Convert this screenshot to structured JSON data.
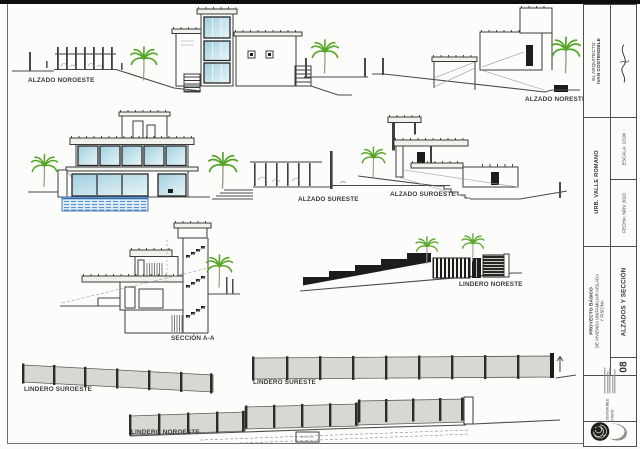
{
  "sheet": {
    "labels": {
      "alzado_noroeste": "ALZADO NOROESTE",
      "alzado_noreste": "ALZADO NORESTE",
      "alzado_sureste": "ALZADO SURESTE",
      "alzado_suroeste": "ALZADO SUROESTE",
      "seccion_aa": "SECCIÓN A-A",
      "lindero_noreste": "LINDERO NORESTE",
      "lindero_suroeste": "LINDERO SUROESTE",
      "lindero_sureste": "LINDERO SURESTE",
      "lindero_noroeste": "LINDERO NOROESTE"
    },
    "titleblock": {
      "architect_label": "EL ARQUITECTO:",
      "architect_name": "IVAN COSTENOBLE",
      "urbanization": "URB. VALLE ROMANO",
      "scale": "ESCALA: 1/100",
      "date": "FECHA: NOV 2010",
      "project_line1": "PROYECTO BÁSICO",
      "project_line2": "DE VIVIENDA UNIFAMILIAR AISLADA",
      "project_line3": "Y PISCINA",
      "sheet_number": "08",
      "sheet_title": "ALZADOS Y SECCIÓN",
      "stamp_line1": "IVAN COSTENOBLE",
      "stamp_line2": "+ QUINTERO"
    },
    "colors": {
      "paper": "#fcfcfa",
      "ink": "#3c3c3c",
      "glass": "#a9d5e2",
      "palm_green": "#57a629",
      "pool_blue": "#4a86c8",
      "fence_gray": "#d8d8d2",
      "wall_black": "#161616"
    }
  }
}
